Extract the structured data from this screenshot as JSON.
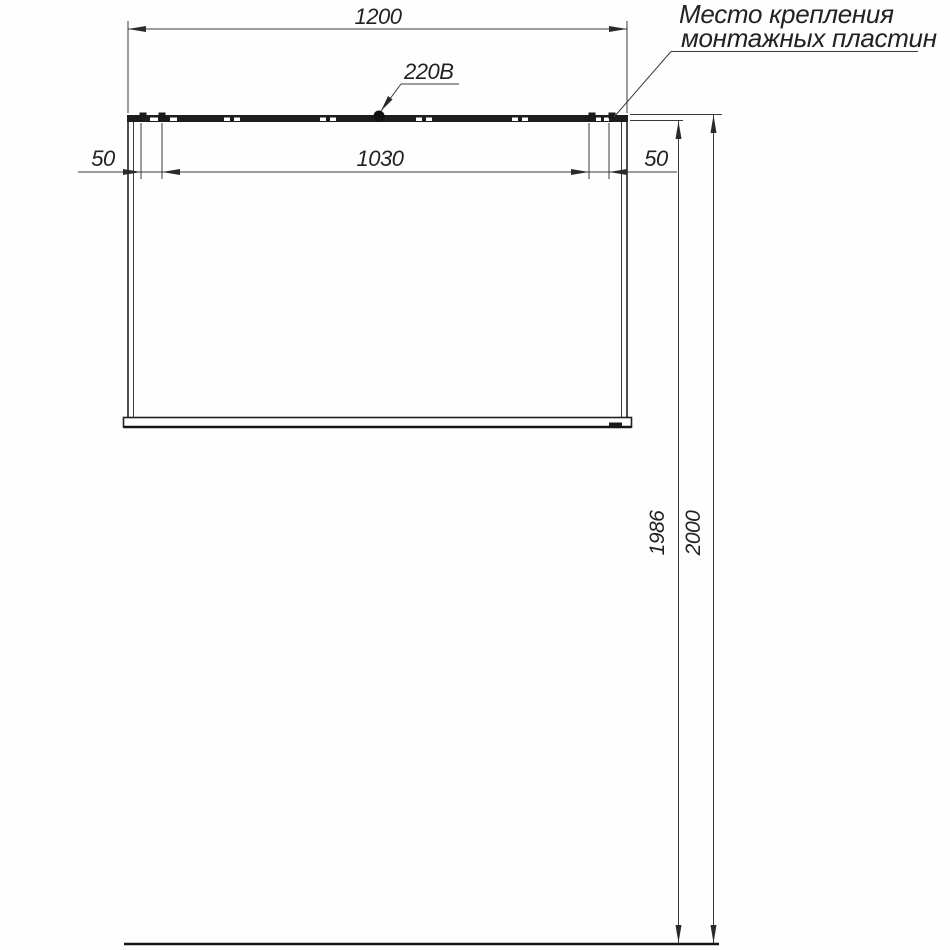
{
  "drawing": {
    "type": "installation-diagram",
    "annotation": {
      "line1": "Место крепления",
      "line2": "монтажных пластин"
    },
    "power_label": "220В",
    "dimensions": {
      "overall_width": "1200",
      "plate_span": "1030",
      "plate_offset_left": "50",
      "plate_offset_right": "50",
      "plate_height_from_floor": "1986",
      "overall_height_from_floor": "2000"
    },
    "colors": {
      "line": "#3b3b3b",
      "panel": "#1d1d1d",
      "text": "#222222",
      "background": "#fefefe"
    }
  }
}
